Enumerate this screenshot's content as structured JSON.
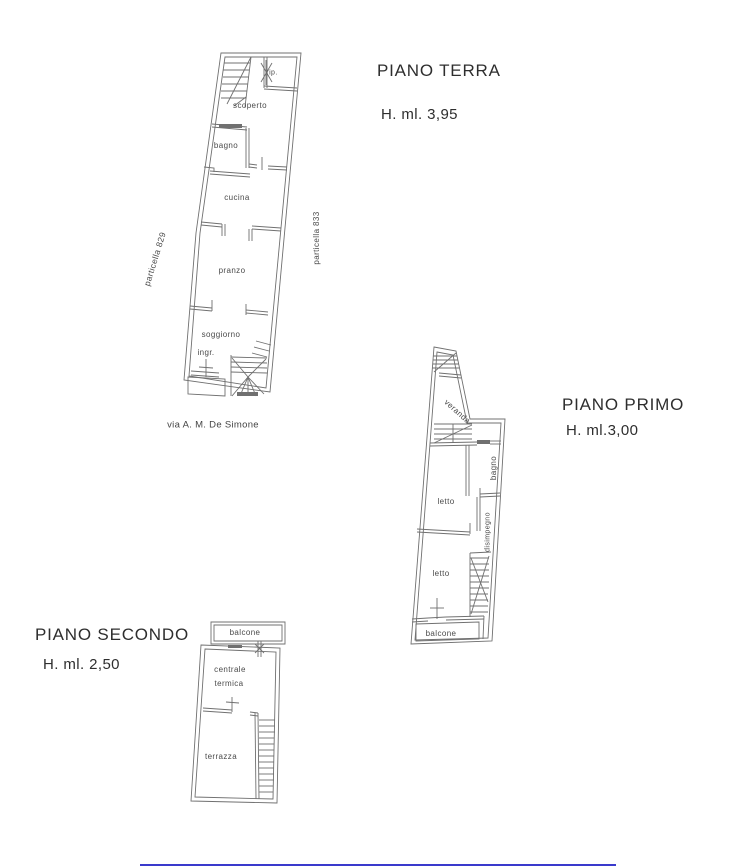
{
  "colors": {
    "background": "#ffffff",
    "linework": "#707070",
    "room_label_text": "#4a4a4a",
    "title_text": "#2e2e2e",
    "bottom_rule": "#3a3acc"
  },
  "floors": {
    "terra": {
      "title": "PIANO TERRA",
      "height_label": "H. ml. 3,95",
      "rooms": {
        "rip": "rip.",
        "scoperto": "scoperto",
        "bagno": "bagno",
        "cucina": "cucina",
        "pranzo": "pranzo",
        "soggiorno": "soggiorno",
        "ingr": "ingr."
      },
      "annotations": {
        "parcel_left": "particella 829",
        "parcel_right": "particella 833",
        "street": "via A. M. De Simone"
      }
    },
    "primo": {
      "title": "PIANO PRIMO",
      "height_label": "H. ml.3,00",
      "rooms": {
        "veranda": "veranda",
        "bagno": "bagno",
        "letto_1": "letto",
        "disimpegno": "disimpegno",
        "letto_2": "letto",
        "balcone": "balcone"
      }
    },
    "secondo": {
      "title": "PIANO SECONDO",
      "height_label": "H. ml. 2,50",
      "rooms": {
        "balcone": "balcone",
        "centrale_line1": "centrale",
        "centrale_line2": "termica",
        "terrazza": "terrazza"
      }
    }
  }
}
